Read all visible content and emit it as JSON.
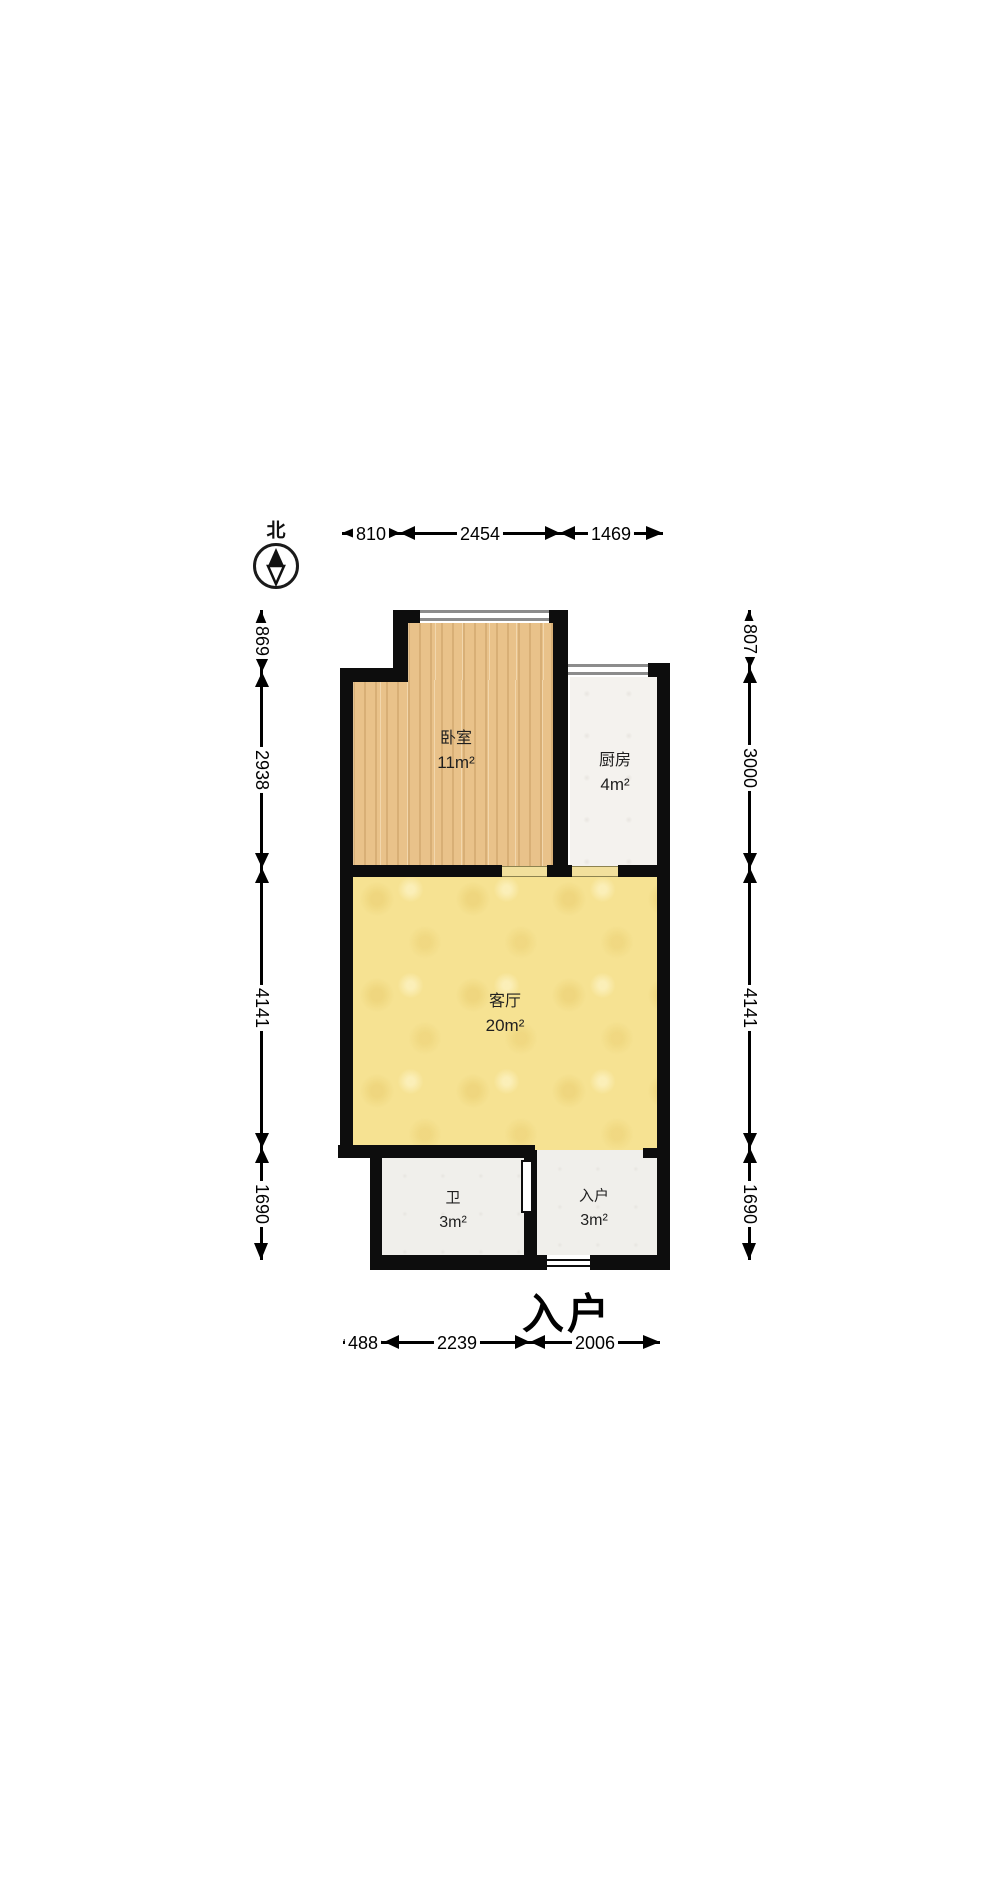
{
  "compass": {
    "north_label": "北"
  },
  "rooms": {
    "bedroom": {
      "name": "卧室",
      "area": "11m²"
    },
    "kitchen": {
      "name": "厨房",
      "area": "4m²"
    },
    "living": {
      "name": "客厅",
      "area": "20m²"
    },
    "bathroom": {
      "name": "卫",
      "area": "3m²"
    },
    "entry": {
      "name": "入户",
      "area": "3m²"
    }
  },
  "entrance": {
    "label": "入户"
  },
  "dimensions": {
    "top": [
      "810",
      "2454",
      "1469"
    ],
    "left": [
      "869",
      "2938",
      "4141",
      "1690"
    ],
    "right": [
      "807",
      "3000",
      "4141",
      "1690"
    ],
    "bottom": [
      "488",
      "2239",
      "2006"
    ]
  },
  "colors": {
    "wall": "#0d0d0d",
    "bedroom_floor": "#e9c28a",
    "kitchen_floor": "#f4f2ee",
    "living_floor": "#f6e292",
    "bath_floor": "#f0efeb",
    "window_line": "#8c8c8c",
    "door_sill": "#f2e09c"
  }
}
